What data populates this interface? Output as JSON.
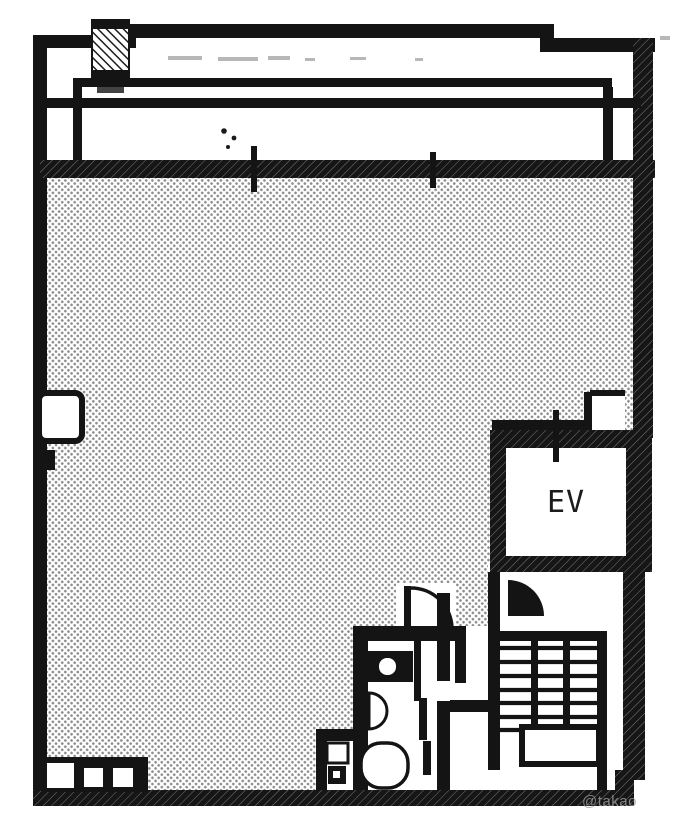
{
  "labels": {
    "elevator": "EV",
    "watermark": "@takao"
  },
  "colors": {
    "wall": "#141414",
    "floor_dot": "#8e8e8e",
    "paper": "#ffffff",
    "watermark": "#9b9b9b"
  }
}
